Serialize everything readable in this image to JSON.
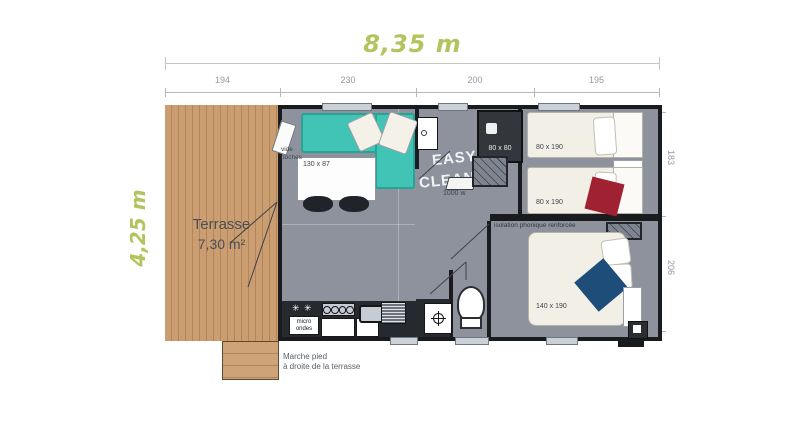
{
  "annotations": {
    "width_total": "8,35 m",
    "height_total": "4,25 m",
    "top_segments": [
      "194",
      "230",
      "200",
      "195"
    ],
    "right_segments": [
      "183",
      "206"
    ]
  },
  "terrace": {
    "title": "Terrasse",
    "area": "7,30 m²"
  },
  "footnote": {
    "line1": "Marche pied",
    "line2": "à droite de la terrasse"
  },
  "living": {
    "vide_poches_line1": "vide",
    "vide_poches_line2": "poches",
    "table_label": "130 x 87"
  },
  "kitchen": {
    "microwave_line1": "micro",
    "microwave_line2": "ondes"
  },
  "bathroom": {
    "brand_line1": "EASY",
    "brand_line2": "CLEAN",
    "shower_label": "80 x 80",
    "heater_label": "1000 w"
  },
  "bedroom_twin": {
    "bed1_label": "80 x 190",
    "bed2_label": "80 x 190"
  },
  "bedroom_master": {
    "bed_label": "140 x 190"
  },
  "separator_label": "isolation phonique renforcée",
  "icons": {
    "microwave_glyph": "✳ ✳"
  },
  "colors": {
    "dimension_green": "#b3c45f",
    "terrace_wood": "#cb9e72",
    "floor_gray": "#8d929c",
    "wall_dark": "#191b1e",
    "sofa_teal": "#41c4b5",
    "bed_cream": "#f2efe6",
    "cushion_red": "#9f2132",
    "cushion_blue": "#1e4d79",
    "counter_dark": "#26292d"
  }
}
